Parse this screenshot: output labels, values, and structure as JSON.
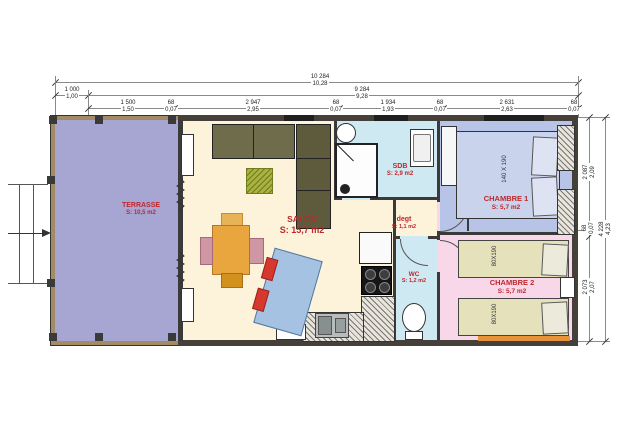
{
  "palette": {
    "label_red": "#c0272d",
    "terrace_fill": "#a7a5d1",
    "salon_fill": "#fcf3da",
    "bath_fill": "#cfe9f3",
    "chambre1_fill": "#b8c4e7",
    "chambre2_fill": "#f8d7e9",
    "bed_khaki": "#e5e2bb",
    "bed_blue": "#c9d3ec",
    "kitchen_unit": "#6e6c4a",
    "table_orange": "#e9a53e",
    "sofa_blue": "#a6c2e3",
    "cushion_red": "#d5382e",
    "wall_tan": "#a28c66",
    "wall_dark": "#46403a",
    "accent_orange_strip": "#e8923a"
  },
  "dims": {
    "top": {
      "total": {
        "mm": "10 284",
        "m": "10,28"
      },
      "row2": [
        {
          "mm": "1 000",
          "m": "1,00"
        },
        {
          "mm": "9 284",
          "m": "9,28"
        }
      ],
      "row3": [
        {
          "mm": "1 500",
          "m": "1,50"
        },
        {
          "mm": "68",
          "m": "0,07"
        },
        {
          "mm": "2 947",
          "m": "2,95"
        },
        {
          "mm": "68",
          "m": "0,07"
        },
        {
          "mm": "1 934",
          "m": "1,93"
        },
        {
          "mm": "68",
          "m": "0,07"
        },
        {
          "mm": "2 631",
          "m": "2,63"
        },
        {
          "mm": "68",
          "m": "0,07"
        }
      ]
    },
    "right": {
      "segments": [
        {
          "mm": "2 087",
          "m": "2,09"
        },
        {
          "mm": "68",
          "m": "0,07"
        },
        {
          "mm": "2 073",
          "m": "2,07"
        }
      ],
      "total": {
        "mm": "4 228",
        "m": "4,23"
      }
    }
  },
  "rooms": {
    "terrasse": {
      "name": "TERRASSE",
      "area": "S: 10,5 m2"
    },
    "salon": {
      "name": "SALON",
      "area": "S: 15,7 m2"
    },
    "sdb": {
      "name": "SDB",
      "area": "S: 2,9 m2"
    },
    "degt": {
      "name": "degt",
      "area": "S: 1,1 m2"
    },
    "wc": {
      "name": "WC",
      "area": "S: 1,2 m2"
    },
    "chambre1": {
      "name": "CHAMBRE 1",
      "area": "S: 5,7 m2",
      "bed_label": "140 X 190"
    },
    "chambre2": {
      "name": "CHAMBRE 2",
      "area": "S: 5,7 m2",
      "bed1_label": "80X190",
      "bed2_label": "80X190"
    }
  }
}
